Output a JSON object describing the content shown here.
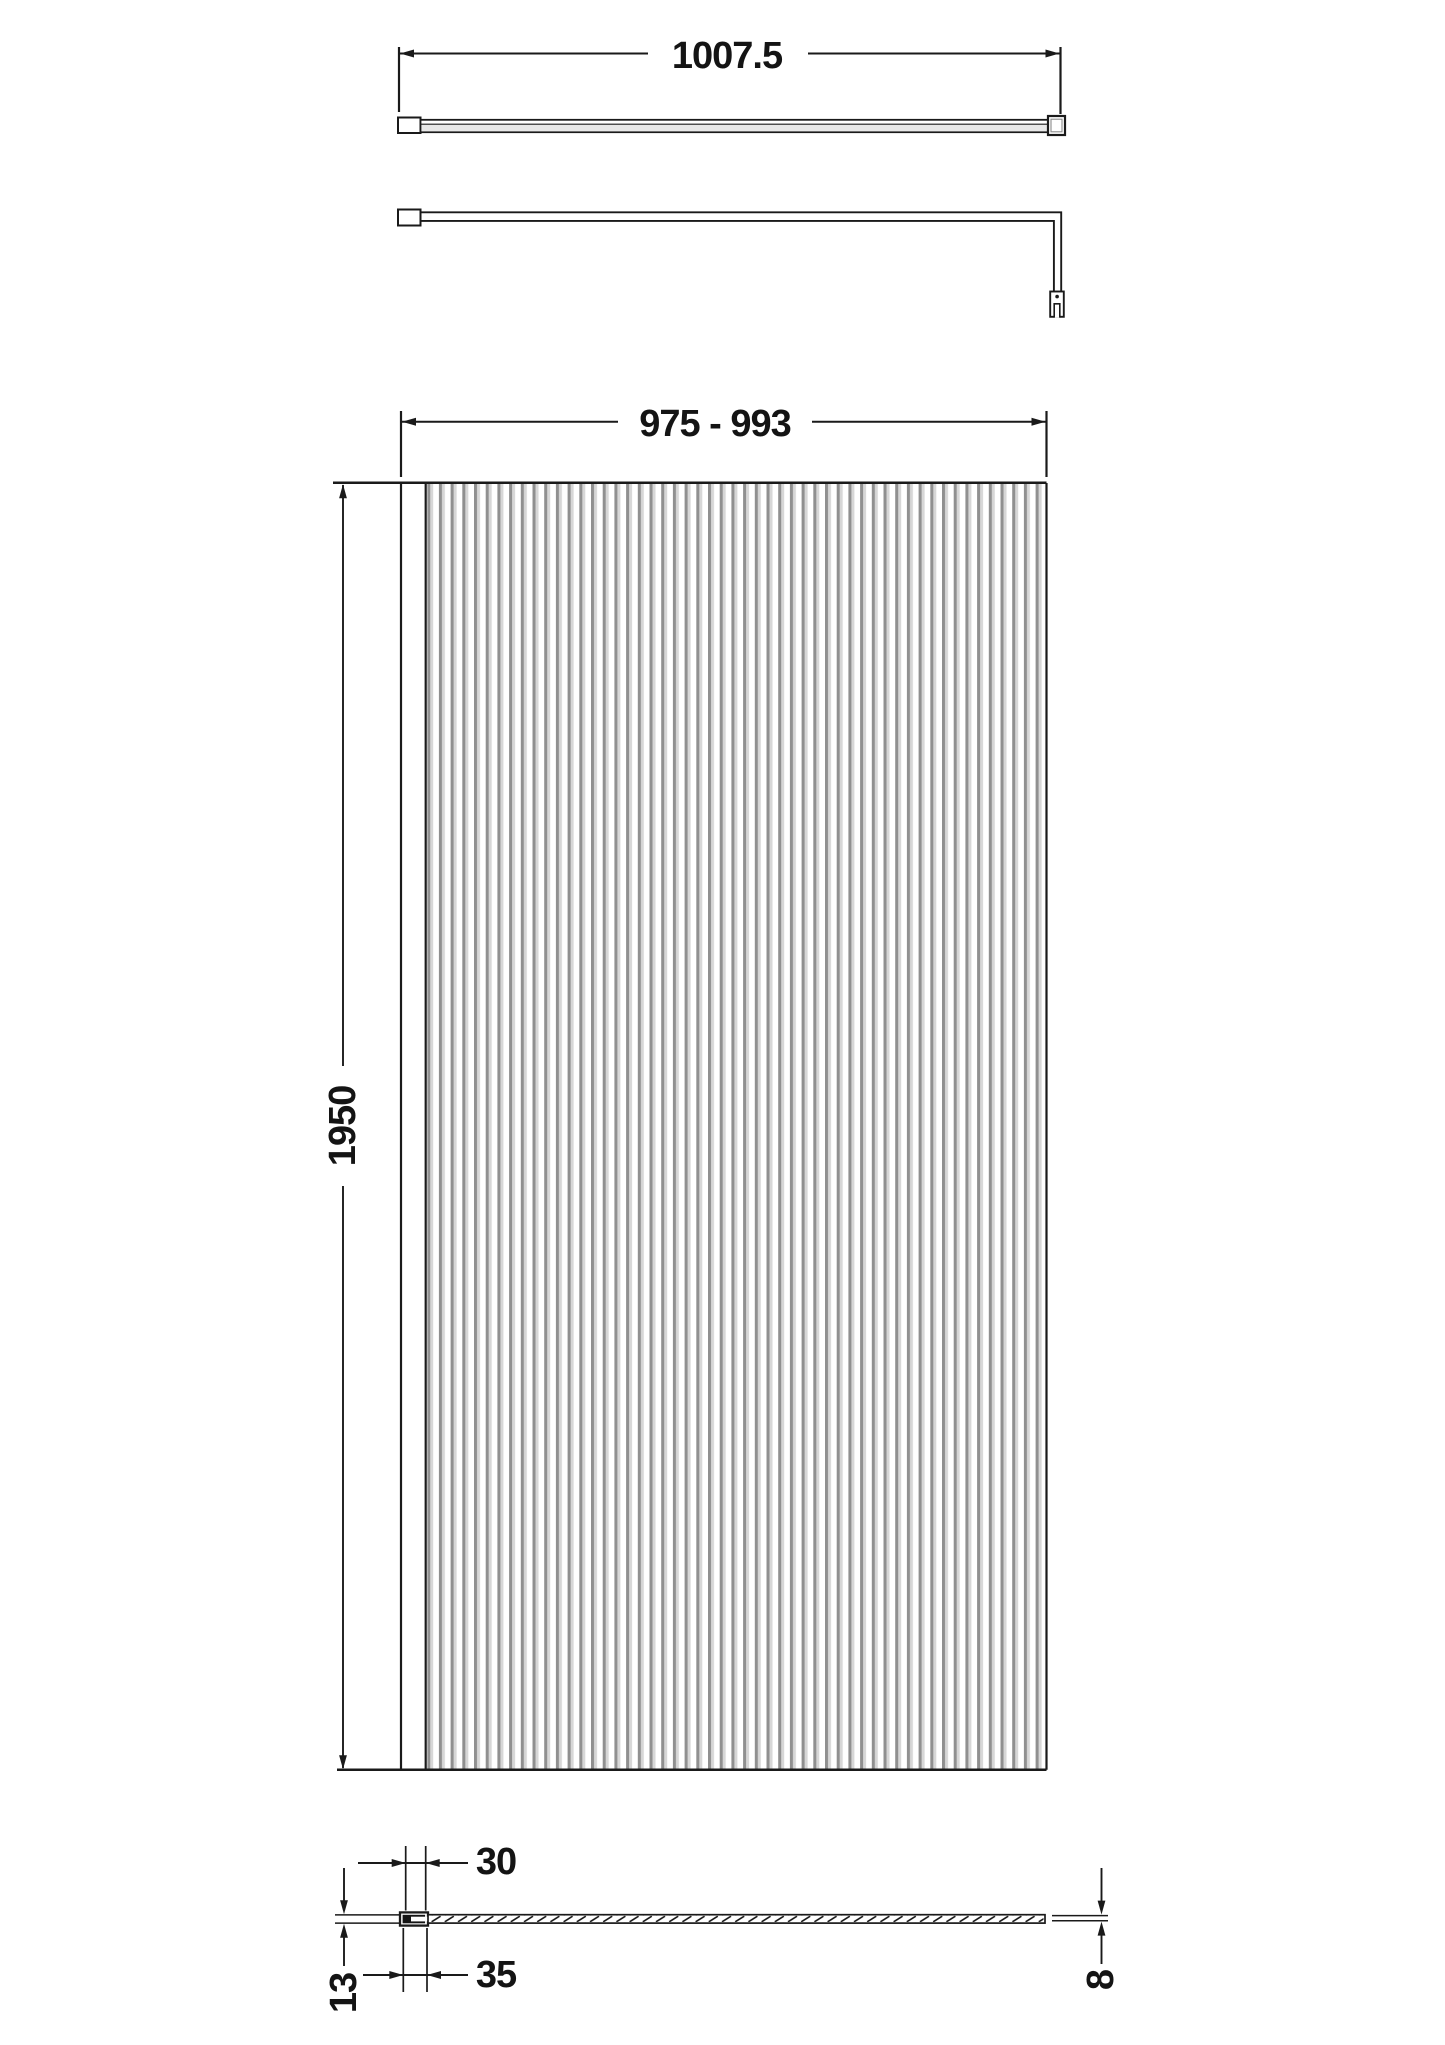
{
  "drawing": {
    "colors": {
      "line": "#1a1a1a",
      "flute_dark": "#909090",
      "flute_light": "#d7d7d7",
      "background": "#ffffff"
    },
    "views": {
      "support_bar_plan": {
        "length_label": "1007.5"
      },
      "support_bar_side": {},
      "front_elevation": {
        "width_label": "975 - 993",
        "height_label": "1950"
      },
      "bottom_section": {
        "top_width_label": "30",
        "bottom_width_label": "35",
        "depth_label": "13",
        "glass_thickness_label": "8"
      }
    }
  }
}
